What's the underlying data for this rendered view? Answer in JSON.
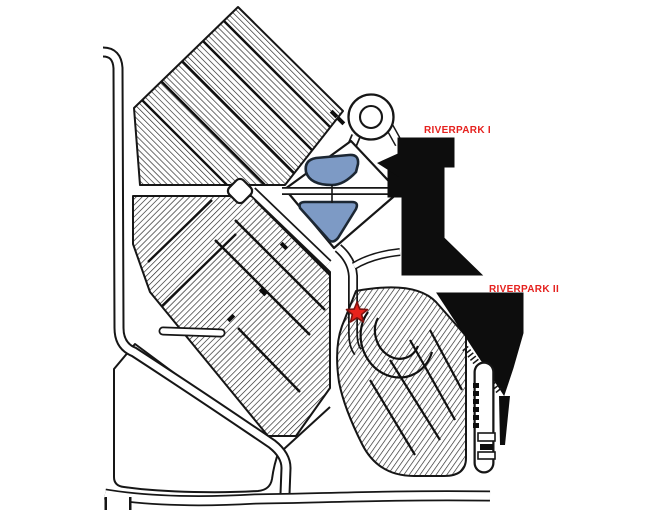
{
  "map": {
    "labels": {
      "building1": "RIVERPARK I",
      "building2": "RIVERPARK II"
    },
    "marker": {
      "shape": "star",
      "color": "#e8231c"
    },
    "colors": {
      "label_red": "#e5211e",
      "star_red": "#e8231c",
      "star_edge": "#7e120e",
      "pond_blue": "#7d9ac5",
      "pond_outline": "#1c2733",
      "building_black": "#0d0d0d",
      "ink": "#161616",
      "background": "#ffffff"
    }
  }
}
